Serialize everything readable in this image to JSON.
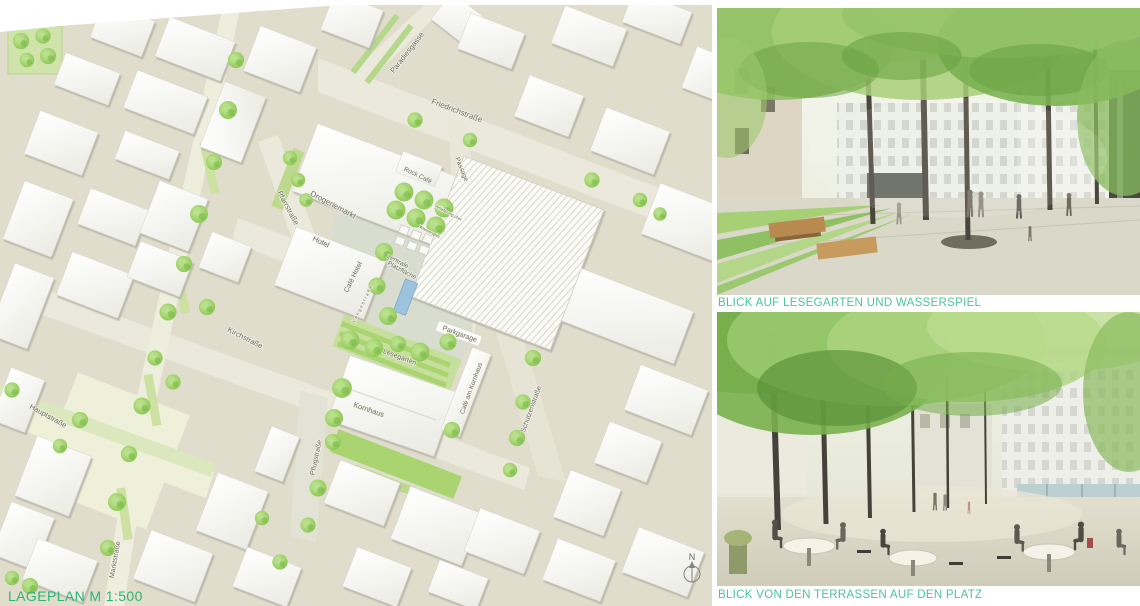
{
  "colors": {
    "caption_green_map": "#2db379",
    "caption_green_renders": "#4cc39b"
  },
  "siteplan": {
    "caption": "LAGEPLAN M 1:500",
    "north": {
      "label": "N"
    },
    "labels": [
      {
        "id": "paradiesgasse",
        "text": "Paradiesgasse",
        "x": 409,
        "y": 54,
        "rot": -52,
        "size": 7.5
      },
      {
        "id": "friedrichstrasse",
        "text": "Friedrichstraße",
        "x": 456,
        "y": 113,
        "rot": 21,
        "size": 8
      },
      {
        "id": "pfarrstrasse",
        "text": "Pfarrstraße",
        "x": 286,
        "y": 209,
        "rot": 62,
        "size": 7.5
      },
      {
        "id": "drogeriemarkt",
        "text": "Drogeriemarkt",
        "x": 332,
        "y": 207,
        "rot": 28,
        "size": 8
      },
      {
        "id": "anlieferung",
        "text": "Anlieferung über",
        "x": 448,
        "y": 214,
        "rot": 28,
        "size": 4
      },
      {
        "id": "rock-cafe",
        "text": "Rock Café",
        "x": 417,
        "y": 177,
        "rot": 26,
        "size": 6.5
      },
      {
        "id": "passage",
        "text": "Passage",
        "x": 460,
        "y": 170,
        "rot": 68,
        "size": 6.5
      },
      {
        "id": "hotel",
        "text": "Hotel",
        "x": 320,
        "y": 244,
        "rot": 25,
        "size": 7.5
      },
      {
        "id": "cafe-hotel",
        "text": "Café Hotel",
        "x": 355,
        "y": 278,
        "rot": -64,
        "size": 7
      },
      {
        "id": "langestrasse",
        "text": "Langestraße",
        "x": 364,
        "y": 304,
        "rot": -64,
        "size": 4.5,
        "ls": 1.5
      },
      {
        "id": "zentrale-platzflaeche-1",
        "text": "zentrale",
        "x": 397,
        "y": 263,
        "rot": 28,
        "size": 6.5
      },
      {
        "id": "zentrale-platzflaeche-2",
        "text": "Platzfläche",
        "x": 401,
        "y": 272,
        "rot": 28,
        "size": 6.5
      },
      {
        "id": "wasserspiel",
        "text": "Wasserspiel",
        "x": 429,
        "y": 233,
        "rot": 28,
        "size": 4.2
      },
      {
        "id": "parkgarage",
        "text": "Parkgarage",
        "x": 459,
        "y": 336,
        "rot": 20,
        "size": 7
      },
      {
        "id": "lesegarten",
        "text": "Lesegarten",
        "x": 399,
        "y": 359,
        "rot": 21,
        "size": 7
      },
      {
        "id": "kornhaus",
        "text": "Kornhaus",
        "x": 368,
        "y": 412,
        "rot": 19,
        "size": 7.5
      },
      {
        "id": "cafe-am-kornhaus",
        "text": "Café am Kornhaus",
        "x": 473,
        "y": 389,
        "rot": -70,
        "size": 6.5
      },
      {
        "id": "kirchstrasse",
        "text": "Kirchstraße",
        "x": 244,
        "y": 340,
        "rot": 27,
        "size": 7.5
      },
      {
        "id": "hauptstrasse",
        "text": "Hauptstraße",
        "x": 47,
        "y": 418,
        "rot": 29,
        "size": 7.5
      },
      {
        "id": "marktstrasse",
        "text": "Marktstraße",
        "x": 117,
        "y": 560,
        "rot": -80,
        "size": 7
      },
      {
        "id": "pflugstrasse",
        "text": "Pflugstraße",
        "x": 318,
        "y": 458,
        "rot": -78,
        "size": 7
      },
      {
        "id": "schuetzenstrasse",
        "text": "Schützenstraße",
        "x": 533,
        "y": 410,
        "rot": -70,
        "size": 7
      }
    ]
  },
  "renders": [
    {
      "id": "lesegarten-wasserspiel",
      "caption": "BLICK AUF LESEGARTEN UND WASSERSPIEL"
    },
    {
      "id": "terrassen-platz",
      "caption": "BLICK VON DEN TERRASSEN AUF DEN PLATZ"
    }
  ]
}
